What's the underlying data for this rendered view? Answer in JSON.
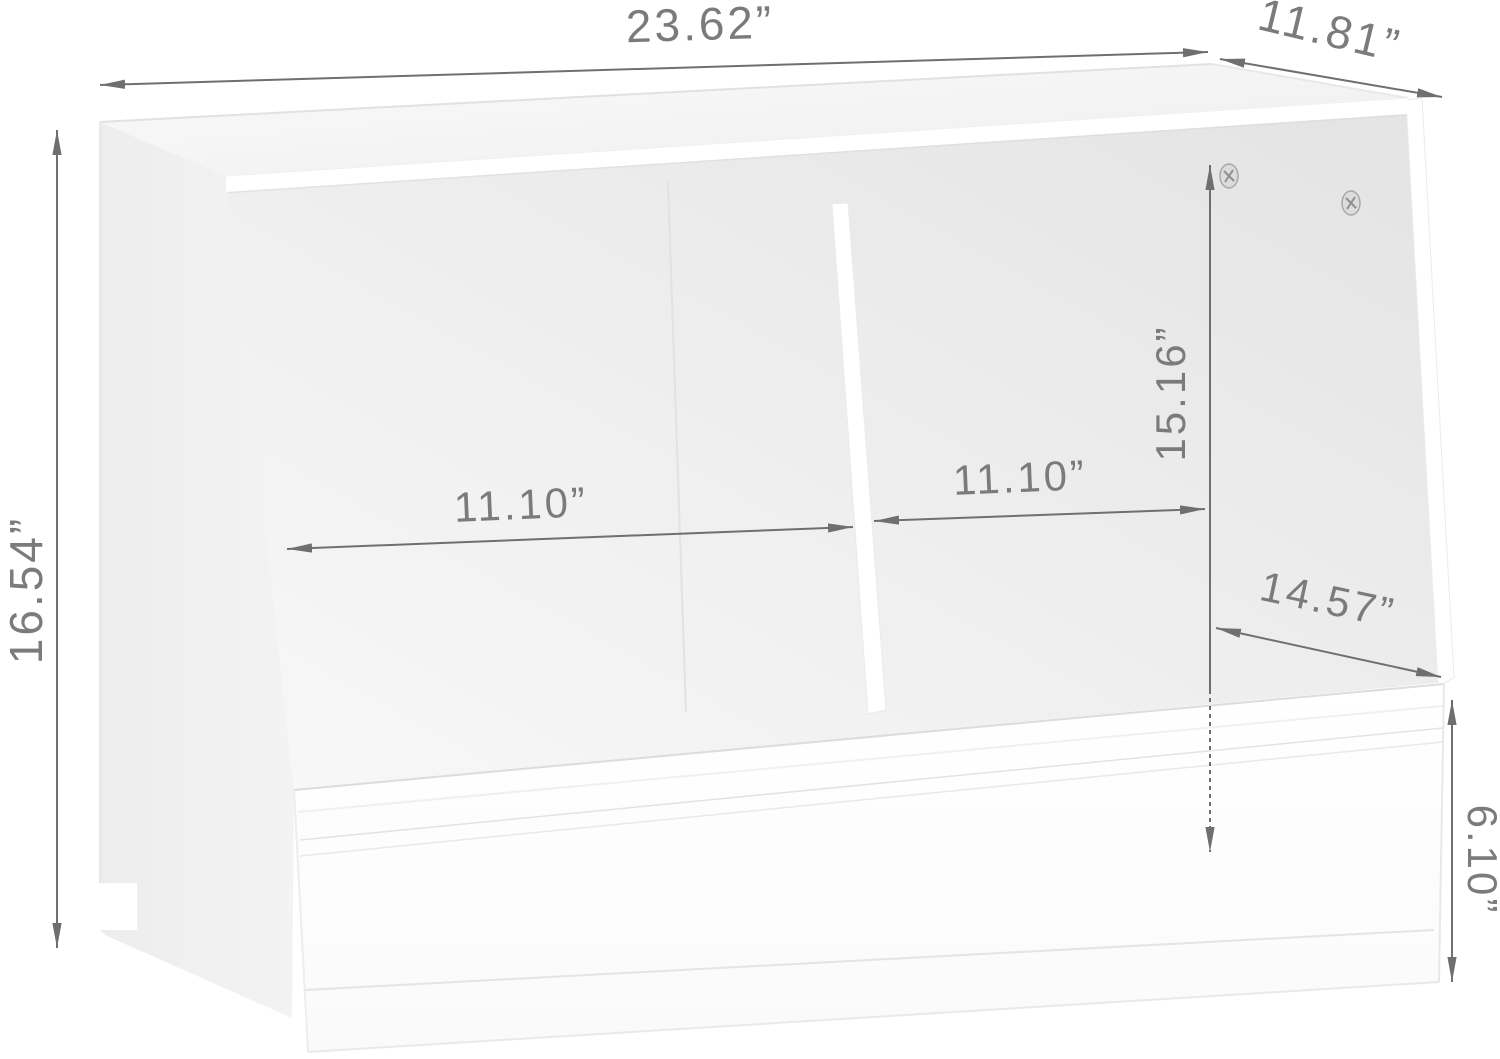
{
  "dims": {
    "top_width": "23.62”",
    "top_depth": "11.81”",
    "overall_height": "16.54”",
    "left_cubby_width": "11.10”",
    "right_cubby_width": "11.10”",
    "interior_height": "15.16”",
    "interior_depth": "14.57”",
    "bin_height": "6.10”"
  },
  "hardware": {
    "screw_count": 2
  },
  "colors": {
    "background": "#ffffff",
    "dimension_line": "#6f6f6f",
    "dimension_text": "#7b7b7b",
    "furniture_white": "#ffffff",
    "panel_shade": "#ececec",
    "interior_shade": "#e6e6e6"
  }
}
